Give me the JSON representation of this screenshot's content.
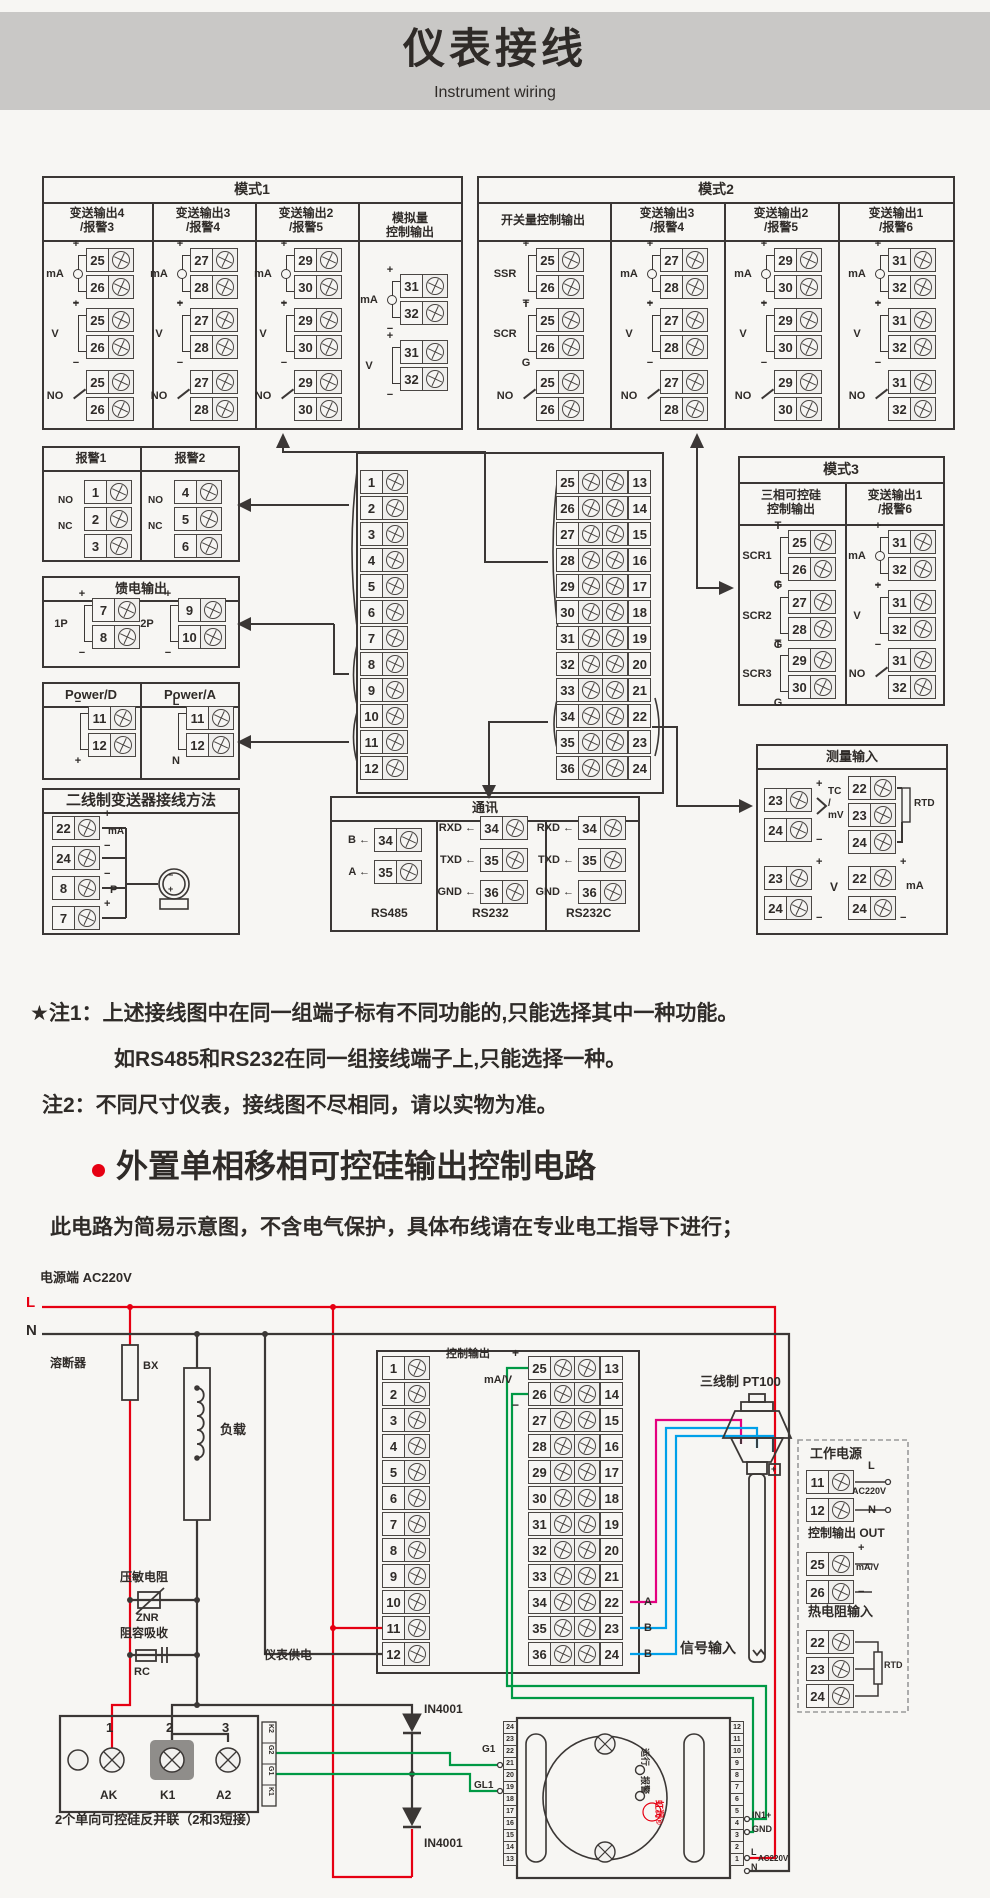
{
  "header": {
    "title": "仪表接线",
    "subtitle": "Instrument wiring"
  },
  "notes": {
    "n1": "★注1：上述接线图中在同一组端子标有不同功能的,只能选择其中一种功能。",
    "n2": "如RS485和RS232在同一组接线端子上,只能选择一种。",
    "n3": "注2：不同尺寸仪表，接线图不尽相同，请以实物为准。"
  },
  "section": {
    "title": "外置单相移相可控硅输出控制电路",
    "note": "此电路为简易示意图，不含电气保护，具体布线请在专业电工指导下进行；"
  },
  "colors": {
    "accent_red": "#e60012",
    "wire_green": "#009944",
    "wire_magenta": "#e4007f",
    "wire_blue": "#00a0e9",
    "line": "#3b3735"
  },
  "centerLeft": [
    "1",
    "2",
    "3",
    "4",
    "5",
    "6",
    "7",
    "8",
    "9",
    "10",
    "11",
    "12"
  ],
  "centerRows": [
    {
      "a": "25",
      "b": "13"
    },
    {
      "a": "26",
      "b": "14"
    },
    {
      "a": "27",
      "b": "15"
    },
    {
      "a": "28",
      "b": "16"
    },
    {
      "a": "29",
      "b": "17"
    },
    {
      "a": "30",
      "b": "18"
    },
    {
      "a": "31",
      "b": "19"
    },
    {
      "a": "32",
      "b": "20"
    },
    {
      "a": "33",
      "b": "21"
    },
    {
      "a": "34",
      "b": "22"
    },
    {
      "a": "35",
      "b": "23"
    },
    {
      "a": "36",
      "b": "24"
    }
  ],
  "trigLeft": [
    "24",
    "23",
    "22",
    "21",
    "20",
    "19",
    "18",
    "17",
    "16",
    "15",
    "14",
    "13"
  ],
  "trigRight": [
    "12",
    "11",
    "10",
    "9",
    "8",
    "7",
    "6",
    "5",
    "4",
    "3",
    "2",
    "1"
  ],
  "groups": [
    {
      "x": 38,
      "y": 248,
      "sig": "mA",
      "tm": "+",
      "bm": "−",
      "t1": "25",
      "t2": "26",
      "cls": "ma"
    },
    {
      "x": 38,
      "y": 308,
      "sig": "V",
      "tm": "+",
      "bm": "−",
      "t1": "25",
      "t2": "26"
    },
    {
      "x": 38,
      "y": 370,
      "sig": "NO",
      "tm": "",
      "bm": "",
      "t1": "25",
      "t2": "26",
      "cls": "no"
    },
    {
      "x": 142,
      "y": 248,
      "sig": "mA",
      "tm": "+",
      "bm": "−",
      "t1": "27",
      "t2": "28",
      "cls": "ma"
    },
    {
      "x": 142,
      "y": 308,
      "sig": "V",
      "tm": "+",
      "bm": "−",
      "t1": "27",
      "t2": "28"
    },
    {
      "x": 142,
      "y": 370,
      "sig": "NO",
      "tm": "",
      "bm": "",
      "t1": "27",
      "t2": "28",
      "cls": "no"
    },
    {
      "x": 246,
      "y": 248,
      "sig": "mA",
      "tm": "+",
      "bm": "−",
      "t1": "29",
      "t2": "30",
      "cls": "ma"
    },
    {
      "x": 246,
      "y": 308,
      "sig": "V",
      "tm": "+",
      "bm": "−",
      "t1": "29",
      "t2": "30"
    },
    {
      "x": 246,
      "y": 370,
      "sig": "NO",
      "tm": "",
      "bm": "",
      "t1": "29",
      "t2": "30",
      "cls": "no"
    },
    {
      "x": 352,
      "y": 274,
      "sig": "mA",
      "tm": "+",
      "bm": "−",
      "t1": "31",
      "t2": "32",
      "cls": "ma"
    },
    {
      "x": 352,
      "y": 340,
      "sig": "V",
      "tm": "+",
      "bm": "−",
      "t1": "31",
      "t2": "32"
    },
    {
      "x": 488,
      "y": 248,
      "sig": "SSR",
      "tm": "+",
      "bm": "−",
      "t1": "25",
      "t2": "26"
    },
    {
      "x": 488,
      "y": 308,
      "sig": "SCR",
      "tm": "T",
      "bm": "G",
      "t1": "25",
      "t2": "26"
    },
    {
      "x": 488,
      "y": 370,
      "sig": "NO",
      "tm": "",
      "bm": "",
      "t1": "25",
      "t2": "26",
      "cls": "no"
    },
    {
      "x": 612,
      "y": 248,
      "sig": "mA",
      "tm": "+",
      "bm": "−",
      "t1": "27",
      "t2": "28",
      "cls": "ma"
    },
    {
      "x": 612,
      "y": 308,
      "sig": "V",
      "tm": "+",
      "bm": "−",
      "t1": "27",
      "t2": "28"
    },
    {
      "x": 612,
      "y": 370,
      "sig": "NO",
      "tm": "",
      "bm": "",
      "t1": "27",
      "t2": "28",
      "cls": "no"
    },
    {
      "x": 726,
      "y": 248,
      "sig": "mA",
      "tm": "+",
      "bm": "−",
      "t1": "29",
      "t2": "30",
      "cls": "ma"
    },
    {
      "x": 726,
      "y": 308,
      "sig": "V",
      "tm": "+",
      "bm": "−",
      "t1": "29",
      "t2": "30"
    },
    {
      "x": 726,
      "y": 370,
      "sig": "NO",
      "tm": "",
      "bm": "",
      "t1": "29",
      "t2": "30",
      "cls": "no"
    },
    {
      "x": 840,
      "y": 248,
      "sig": "mA",
      "tm": "+",
      "bm": "−",
      "t1": "31",
      "t2": "32",
      "cls": "ma"
    },
    {
      "x": 840,
      "y": 308,
      "sig": "V",
      "tm": "+",
      "bm": "−",
      "t1": "31",
      "t2": "32"
    },
    {
      "x": 840,
      "y": 370,
      "sig": "NO",
      "tm": "",
      "bm": "",
      "t1": "31",
      "t2": "32",
      "cls": "no"
    },
    {
      "x": 740,
      "y": 530,
      "sig": "SCR1",
      "tm": "T",
      "bm": "G",
      "t1": "25",
      "t2": "26"
    },
    {
      "x": 740,
      "y": 590,
      "sig": "SCR2",
      "tm": "T",
      "bm": "G",
      "t1": "27",
      "t2": "28"
    },
    {
      "x": 740,
      "y": 648,
      "sig": "SCR3",
      "tm": "T",
      "bm": "G",
      "t1": "29",
      "t2": "30"
    },
    {
      "x": 840,
      "y": 530,
      "sig": "mA",
      "tm": "+",
      "bm": "−",
      "t1": "31",
      "t2": "32",
      "cls": "ma"
    },
    {
      "x": 840,
      "y": 590,
      "sig": "V",
      "tm": "+",
      "bm": "−",
      "t1": "31",
      "t2": "32"
    },
    {
      "x": 840,
      "y": 648,
      "sig": "NO",
      "tm": "",
      "bm": "",
      "t1": "31",
      "t2": "32",
      "cls": "no"
    },
    {
      "x": 44,
      "y": 598,
      "sig": "1P",
      "tm": "+",
      "bm": "−",
      "t1": "7",
      "t2": "8"
    },
    {
      "x": 130,
      "y": 598,
      "sig": "2P",
      "tm": "+",
      "bm": "−",
      "t1": "9",
      "t2": "10"
    },
    {
      "x": 40,
      "y": 706,
      "sig": "",
      "tm": "−",
      "bm": "+",
      "t1": "11",
      "t2": "12"
    },
    {
      "x": 138,
      "y": 706,
      "sig": "",
      "tm": "L",
      "bm": "N",
      "t1": "11",
      "t2": "12"
    }
  ],
  "terms": [
    {
      "x": 52,
      "y": 816,
      "n": "22"
    },
    {
      "x": 52,
      "y": 846,
      "n": "24"
    },
    {
      "x": 52,
      "y": 876,
      "n": "8"
    },
    {
      "x": 52,
      "y": 906,
      "n": "7"
    },
    {
      "x": 84,
      "y": 480,
      "n": "1"
    },
    {
      "x": 84,
      "y": 507,
      "n": "2"
    },
    {
      "x": 84,
      "y": 534,
      "n": "3"
    },
    {
      "x": 174,
      "y": 480,
      "n": "4"
    },
    {
      "x": 174,
      "y": 507,
      "n": "5"
    },
    {
      "x": 174,
      "y": 534,
      "n": "6"
    },
    {
      "x": 374,
      "y": 828,
      "n": "34"
    },
    {
      "x": 374,
      "y": 860,
      "n": "35"
    },
    {
      "x": 480,
      "y": 816,
      "n": "34"
    },
    {
      "x": 480,
      "y": 848,
      "n": "35"
    },
    {
      "x": 480,
      "y": 880,
      "n": "36"
    },
    {
      "x": 578,
      "y": 816,
      "n": "34"
    },
    {
      "x": 578,
      "y": 848,
      "n": "35"
    },
    {
      "x": 578,
      "y": 880,
      "n": "36"
    },
    {
      "x": 764,
      "y": 788,
      "n": "23"
    },
    {
      "x": 764,
      "y": 818,
      "n": "24"
    },
    {
      "x": 848,
      "y": 776,
      "n": "22"
    },
    {
      "x": 848,
      "y": 803,
      "n": "23"
    },
    {
      "x": 848,
      "y": 830,
      "n": "24"
    },
    {
      "x": 764,
      "y": 866,
      "n": "23"
    },
    {
      "x": 764,
      "y": 896,
      "n": "24"
    },
    {
      "x": 848,
      "y": 866,
      "n": "22"
    },
    {
      "x": 848,
      "y": 896,
      "n": "24"
    },
    {
      "x": 806,
      "y": 1470,
      "n": "11"
    },
    {
      "x": 806,
      "y": 1498,
      "n": "12"
    },
    {
      "x": 806,
      "y": 1552,
      "n": "25"
    },
    {
      "x": 806,
      "y": 1580,
      "n": "26"
    },
    {
      "x": 806,
      "y": 1630,
      "n": "22"
    },
    {
      "x": 806,
      "y": 1657,
      "n": "23"
    },
    {
      "x": 806,
      "y": 1684,
      "n": "24"
    }
  ],
  "labels": [
    {
      "x": 252,
      "y": 181,
      "t": "模式1",
      "cls": "s14 ctr"
    },
    {
      "x": 97,
      "y": 206,
      "t": "变送输出4\n/报警3",
      "cls": "s12 ctr"
    },
    {
      "x": 203,
      "y": 206,
      "t": "变送输出3\n/报警4",
      "cls": "s12 ctr"
    },
    {
      "x": 306,
      "y": 206,
      "t": "变送输出2\n/报警5",
      "cls": "s12 ctr"
    },
    {
      "x": 410,
      "y": 211,
      "t": "模拟量\n控制输出",
      "cls": "s12 ctr"
    },
    {
      "x": 716,
      "y": 181,
      "t": "模式2",
      "cls": "s14 ctr"
    },
    {
      "x": 543,
      "y": 213,
      "t": "开关量控制输出",
      "cls": "s12 ctr"
    },
    {
      "x": 667,
      "y": 206,
      "t": "变送输出3\n/报警4",
      "cls": "s12 ctr"
    },
    {
      "x": 781,
      "y": 206,
      "t": "变送输出2\n/报警5",
      "cls": "s12 ctr"
    },
    {
      "x": 896,
      "y": 206,
      "t": "变送输出1\n/报警6",
      "cls": "s12 ctr"
    },
    {
      "x": 841,
      "y": 461,
      "t": "模式3",
      "cls": "s14 ctr"
    },
    {
      "x": 791,
      "y": 488,
      "t": "三相可控硅\n控制输出",
      "cls": "s12 ctr"
    },
    {
      "x": 895,
      "y": 488,
      "t": "变送输出1\n/报警6",
      "cls": "s12 ctr"
    },
    {
      "x": 91,
      "y": 451,
      "t": "报警1",
      "cls": "s12 ctr"
    },
    {
      "x": 190,
      "y": 451,
      "t": "报警2",
      "cls": "s12 ctr"
    },
    {
      "x": 141,
      "y": 581,
      "t": "馈电输出",
      "cls": "s13 ctr"
    },
    {
      "x": 91,
      "y": 687,
      "t": "Power/D",
      "cls": "s13 ctr"
    },
    {
      "x": 190,
      "y": 687,
      "t": "Power/A",
      "cls": "s13 ctr"
    },
    {
      "x": 141,
      "y": 792,
      "t": "二线制变送器接线方法",
      "cls": "s15 ctr"
    },
    {
      "x": 485,
      "y": 800,
      "t": "通讯",
      "cls": "s13 ctr"
    },
    {
      "x": 371,
      "y": 906,
      "t": "RS485",
      "cls": "s12"
    },
    {
      "x": 472,
      "y": 906,
      "t": "RS232",
      "cls": "s12"
    },
    {
      "x": 566,
      "y": 906,
      "t": "RS232C",
      "cls": "s12"
    },
    {
      "x": 852,
      "y": 749,
      "t": "测量输入",
      "cls": "s13 ctr"
    },
    {
      "x": 370,
      "y": 834,
      "t": "B ←",
      "cls": "s11 ra"
    },
    {
      "x": 370,
      "y": 866,
      "t": "A ←",
      "cls": "s11 ra"
    },
    {
      "x": 476,
      "y": 822,
      "t": "RXD ←",
      "cls": "s11 ra"
    },
    {
      "x": 476,
      "y": 854,
      "t": "TXD ←",
      "cls": "s11 ra"
    },
    {
      "x": 476,
      "y": 886,
      "t": "GND ←",
      "cls": "s11 ra"
    },
    {
      "x": 574,
      "y": 822,
      "t": "RXD ←",
      "cls": "s11 ra"
    },
    {
      "x": 574,
      "y": 854,
      "t": "TXD ←",
      "cls": "s11 ra"
    },
    {
      "x": 574,
      "y": 886,
      "t": "GND ←",
      "cls": "s11 ra"
    },
    {
      "x": 58,
      "y": 495,
      "t": "NO",
      "cls": "s10"
    },
    {
      "x": 58,
      "y": 521,
      "t": "NC",
      "cls": "s10"
    },
    {
      "x": 148,
      "y": 495,
      "t": "NO",
      "cls": "s10"
    },
    {
      "x": 148,
      "y": 521,
      "t": "NC",
      "cls": "s10"
    },
    {
      "x": 104,
      "y": 808,
      "t": "+",
      "cls": "s11"
    },
    {
      "x": 108,
      "y": 826,
      "t": "mA",
      "cls": "s10"
    },
    {
      "x": 104,
      "y": 840,
      "t": "−",
      "cls": "s11"
    },
    {
      "x": 104,
      "y": 868,
      "t": "−",
      "cls": "s11"
    },
    {
      "x": 110,
      "y": 884,
      "t": "P",
      "cls": "s11"
    },
    {
      "x": 104,
      "y": 898,
      "t": "+",
      "cls": "s11"
    },
    {
      "x": 168,
      "y": 870,
      "t": "−",
      "cls": "s9"
    },
    {
      "x": 168,
      "y": 884,
      "t": "+",
      "cls": "s9"
    },
    {
      "x": 816,
      "y": 778,
      "t": "+",
      "cls": "s11"
    },
    {
      "x": 816,
      "y": 834,
      "t": "−",
      "cls": "s11"
    },
    {
      "x": 828,
      "y": 786,
      "t": "TC\n/\nmV",
      "cls": "s10"
    },
    {
      "x": 914,
      "y": 798,
      "t": "RTD",
      "cls": "s10"
    },
    {
      "x": 816,
      "y": 856,
      "t": "+",
      "cls": "s11"
    },
    {
      "x": 816,
      "y": 912,
      "t": "−",
      "cls": "s11"
    },
    {
      "x": 830,
      "y": 880,
      "t": "V",
      "cls": "s12"
    },
    {
      "x": 900,
      "y": 856,
      "t": "+",
      "cls": "s11"
    },
    {
      "x": 900,
      "y": 912,
      "t": "−",
      "cls": "s11"
    },
    {
      "x": 906,
      "y": 880,
      "t": "mA",
      "cls": "s11"
    },
    {
      "x": 40,
      "y": 1270,
      "t": "电源端  AC220V",
      "cls": "s13"
    },
    {
      "x": 26,
      "y": 1294,
      "t": "L",
      "cls": "s15 red"
    },
    {
      "x": 26,
      "y": 1322,
      "t": "N",
      "cls": "s15"
    },
    {
      "x": 50,
      "y": 1356,
      "t": "溶断器",
      "cls": "s12"
    },
    {
      "x": 143,
      "y": 1360,
      "t": "BX",
      "cls": "s11"
    },
    {
      "x": 220,
      "y": 1422,
      "t": "负载",
      "cls": "s13"
    },
    {
      "x": 120,
      "y": 1570,
      "t": "压敏电阻",
      "cls": "s12"
    },
    {
      "x": 136,
      "y": 1612,
      "t": "ZNR",
      "cls": "s11"
    },
    {
      "x": 120,
      "y": 1626,
      "t": "阻容吸收",
      "cls": "s12"
    },
    {
      "x": 134,
      "y": 1666,
      "t": "RC",
      "cls": "s11"
    },
    {
      "x": 264,
      "y": 1648,
      "t": "仪表供电",
      "cls": "s12"
    },
    {
      "x": 446,
      "y": 1348,
      "t": "控制输出",
      "cls": "s11"
    },
    {
      "x": 512,
      "y": 1346,
      "t": "+",
      "cls": "s12"
    },
    {
      "x": 484,
      "y": 1374,
      "t": "mA/V",
      "cls": "s11"
    },
    {
      "x": 512,
      "y": 1398,
      "t": "−",
      "cls": "s12"
    },
    {
      "x": 424,
      "y": 1702,
      "t": "IN4001",
      "cls": "s12"
    },
    {
      "x": 424,
      "y": 1836,
      "t": "IN4001",
      "cls": "s12"
    },
    {
      "x": 55,
      "y": 1812,
      "t": "2个单向可控硅反并联（2和3短接）",
      "cls": "s13"
    },
    {
      "x": 106,
      "y": 1720,
      "t": "1",
      "cls": "s13"
    },
    {
      "x": 166,
      "y": 1720,
      "t": "2",
      "cls": "s13"
    },
    {
      "x": 222,
      "y": 1720,
      "t": "3",
      "cls": "s13"
    },
    {
      "x": 100,
      "y": 1788,
      "t": "AK",
      "cls": "s12"
    },
    {
      "x": 160,
      "y": 1788,
      "t": "K1",
      "cls": "s12"
    },
    {
      "x": 216,
      "y": 1788,
      "t": "A2",
      "cls": "s12"
    },
    {
      "x": 482,
      "y": 1744,
      "t": "G1",
      "cls": "s10"
    },
    {
      "x": 474,
      "y": 1780,
      "t": "GL1",
      "cls": "s10"
    },
    {
      "x": 644,
      "y": 1596,
      "t": "A",
      "cls": "s11"
    },
    {
      "x": 644,
      "y": 1622,
      "t": "B",
      "cls": "s11"
    },
    {
      "x": 644,
      "y": 1648,
      "t": "B",
      "cls": "s11"
    },
    {
      "x": 680,
      "y": 1640,
      "t": "信号输入",
      "cls": "s14"
    },
    {
      "x": 700,
      "y": 1374,
      "t": "三线制 PT100",
      "cls": "s13"
    },
    {
      "x": 771,
      "y": 1464,
      "t": "+",
      "cls": "s9"
    },
    {
      "x": 810,
      "y": 1446,
      "t": "工作电源",
      "cls": "s13"
    },
    {
      "x": 868,
      "y": 1460,
      "t": "L",
      "cls": "s11"
    },
    {
      "x": 852,
      "y": 1486,
      "t": "AC220V",
      "cls": "s9"
    },
    {
      "x": 868,
      "y": 1504,
      "t": "N",
      "cls": "s11"
    },
    {
      "x": 808,
      "y": 1526,
      "t": "控制输出 OUT",
      "cls": "s12"
    },
    {
      "x": 858,
      "y": 1542,
      "t": "+",
      "cls": "s11"
    },
    {
      "x": 856,
      "y": 1562,
      "t": "mA/V",
      "cls": "s9"
    },
    {
      "x": 858,
      "y": 1586,
      "t": "−",
      "cls": "s11"
    },
    {
      "x": 808,
      "y": 1604,
      "t": "热电阻输入",
      "cls": "s13"
    },
    {
      "x": 884,
      "y": 1660,
      "t": "RTD",
      "cls": "s9"
    },
    {
      "x": 752,
      "y": 1810,
      "t": "IN1+",
      "cls": "s9"
    },
    {
      "x": 752,
      "y": 1824,
      "t": "GND",
      "cls": "s9"
    },
    {
      "x": 751,
      "y": 1847,
      "t": "L",
      "cls": "s9"
    },
    {
      "x": 758,
      "y": 1854,
      "t": "AC220V",
      "cls": "s8"
    },
    {
      "x": 751,
      "y": 1862,
      "t": "N",
      "cls": "s9"
    },
    {
      "x": 650,
      "y": 1748,
      "t": "运行",
      "cls": "s9 rot"
    },
    {
      "x": 650,
      "y": 1776,
      "t": "报警",
      "cls": "s9 rot"
    },
    {
      "x": 664,
      "y": 1800,
      "t": "虹润®",
      "cls": "s9 rot red"
    },
    {
      "x": 274,
      "y": 1724,
      "t": "K2",
      "cls": "s7 rot"
    },
    {
      "x": 274,
      "y": 1745,
      "t": "G2",
      "cls": "s7 rot"
    },
    {
      "x": 274,
      "y": 1766,
      "t": "G1",
      "cls": "s7 rot"
    },
    {
      "x": 274,
      "y": 1787,
      "t": "K1",
      "cls": "s7 rot"
    }
  ]
}
